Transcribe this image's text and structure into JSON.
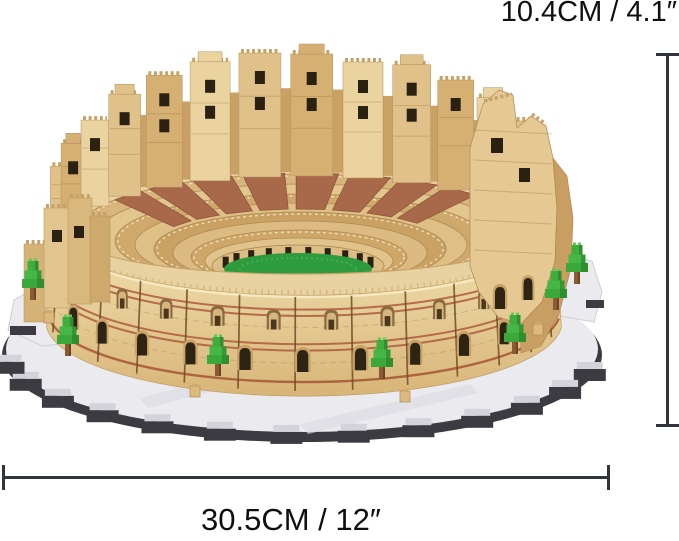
{
  "product_figure": {
    "background_color": "#ffffff",
    "figure_alt": "Micro-brick Colosseum building-block model with ruined outer walls, tiered seating, green arena floor and small brick trees on a gray stepped display base",
    "annotations": {
      "height_label": "10.4CM / 4.1″",
      "width_label": "30.5CM / 12″",
      "line_color": "#2f353b",
      "text_color": "#0f0f0f"
    },
    "palette": {
      "stone_light": "#ebd3a0",
      "stone_mid": "#dcbb82",
      "stone_dark": "#c89e62",
      "walkway_tan": "#e8d2a1",
      "terracotta": "#a8684a",
      "stripe_red": "#b06040",
      "pilaster_brown": "#6f4c28",
      "opening_dark": "#2a2113",
      "arena_green": "#2e9c3e",
      "tree_green": "#3fae3f",
      "trunk_brown": "#8a5a32",
      "base_light": "#eaeaef",
      "base_dark": "#3b3b41"
    }
  }
}
